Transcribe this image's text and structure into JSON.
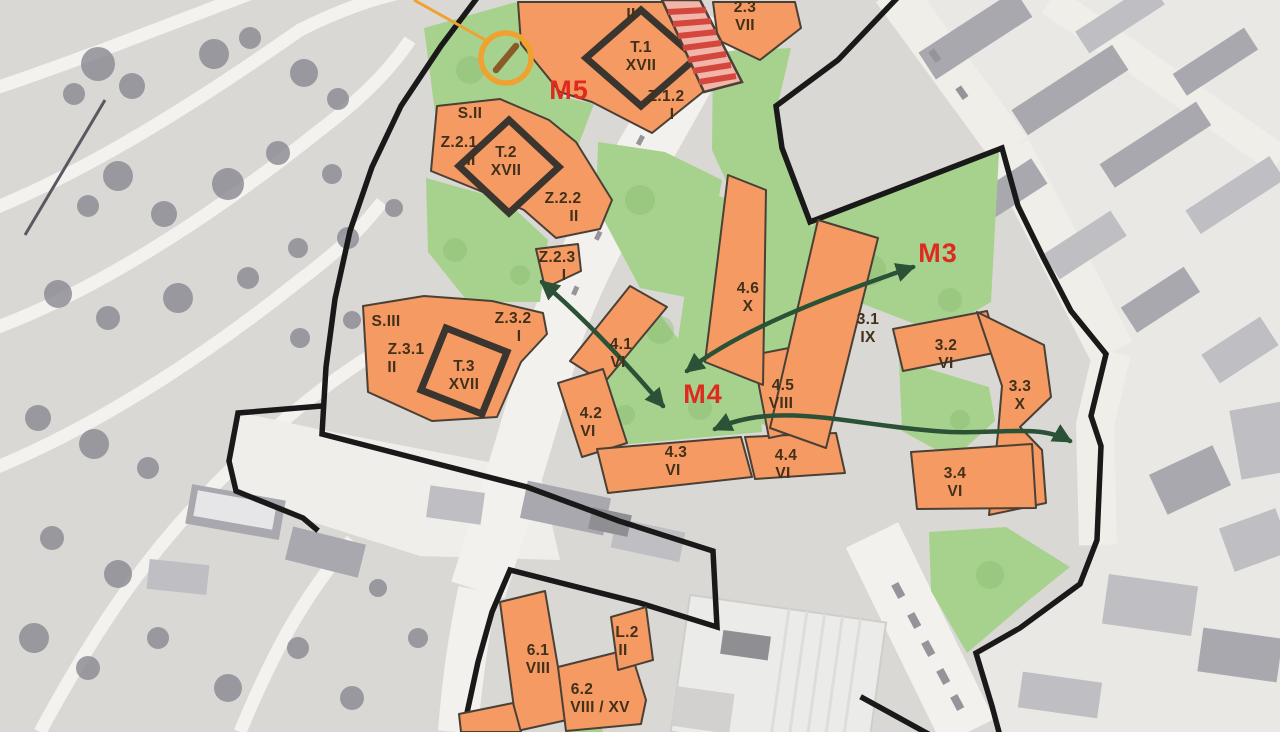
{
  "map": {
    "colors": {
      "building": "#f49a62",
      "green": "#a7d28e",
      "boundary": "#191919",
      "zone_label": "#de2a1f",
      "code_label": "#42301a",
      "arrow": "#2b5136",
      "highlight_circle": "#f0a230",
      "stripe": "#d4473c"
    },
    "zone_labels": [
      {
        "text": "M5",
        "x": 569,
        "y": 99
      },
      {
        "text": "M4",
        "x": 703,
        "y": 403
      },
      {
        "text": "M3",
        "x": 938,
        "y": 262
      }
    ],
    "building_labels": [
      {
        "id": "partial-top",
        "x": 631,
        "y": 19,
        "lines": [
          "II"
        ]
      },
      {
        "id": "t1",
        "x": 641,
        "y": 52,
        "lines": [
          "T.1",
          "XVII"
        ]
      },
      {
        "id": "b23",
        "x": 745,
        "y": 12,
        "lines": [
          "2.3",
          "VII"
        ]
      },
      {
        "id": "z12",
        "x": 666,
        "y": 101,
        "lines": [
          "Z.1.2",
          "I"
        ],
        "dx2": 6
      },
      {
        "id": "s2",
        "x": 470,
        "y": 118,
        "lines": [
          "S.II"
        ]
      },
      {
        "id": "z21",
        "x": 459,
        "y": 147,
        "lines": [
          "Z.2.1",
          "II"
        ],
        "dx2": 12
      },
      {
        "id": "t2",
        "x": 506,
        "y": 157,
        "lines": [
          "T.2",
          "XVII"
        ]
      },
      {
        "id": "z22",
        "x": 563,
        "y": 203,
        "lines": [
          "Z.2.2",
          "II"
        ],
        "dx2": 11
      },
      {
        "id": "z23",
        "x": 557,
        "y": 262,
        "lines": [
          "Z.2.3",
          "I"
        ],
        "dx2": 7
      },
      {
        "id": "s3",
        "x": 386,
        "y": 326,
        "lines": [
          "S.III"
        ]
      },
      {
        "id": "z31",
        "x": 406,
        "y": 354,
        "lines": [
          "Z.3.1",
          "II"
        ],
        "dx2": -14
      },
      {
        "id": "z32",
        "x": 513,
        "y": 323,
        "lines": [
          "Z.3.2",
          "I"
        ],
        "dx2": 6
      },
      {
        "id": "t3",
        "x": 464,
        "y": 371,
        "lines": [
          "T.3",
          "XVII"
        ]
      },
      {
        "id": "b41",
        "x": 621,
        "y": 349,
        "lines": [
          "4.1",
          "VI"
        ],
        "dx2": -3
      },
      {
        "id": "b42",
        "x": 591,
        "y": 418,
        "lines": [
          "4.2",
          "VI"
        ],
        "dx2": -3
      },
      {
        "id": "b43",
        "x": 676,
        "y": 457,
        "lines": [
          "4.3",
          "VI"
        ],
        "dx2": -3
      },
      {
        "id": "b44",
        "x": 786,
        "y": 460,
        "lines": [
          "4.4",
          "VI"
        ],
        "dx2": -3
      },
      {
        "id": "b45",
        "x": 783,
        "y": 390,
        "lines": [
          "4.5",
          "VIII"
        ],
        "dx2": -2
      },
      {
        "id": "b46",
        "x": 748,
        "y": 293,
        "lines": [
          "4.6",
          "X"
        ]
      },
      {
        "id": "b31",
        "x": 868,
        "y": 324,
        "lines": [
          "3.1",
          "IX"
        ]
      },
      {
        "id": "b32",
        "x": 946,
        "y": 350,
        "lines": [
          "3.2",
          "VI"
        ]
      },
      {
        "id": "b33",
        "x": 1020,
        "y": 391,
        "lines": [
          "3.3",
          "X"
        ]
      },
      {
        "id": "b34",
        "x": 955,
        "y": 478,
        "lines": [
          "3.4",
          "VI"
        ]
      },
      {
        "id": "b61",
        "x": 538,
        "y": 655,
        "lines": [
          "6.1",
          "VIII"
        ]
      },
      {
        "id": "b62",
        "x": 582,
        "y": 694,
        "lines": [
          "6.2",
          "VIII / XV"
        ],
        "dx2": 18
      },
      {
        "id": "l2",
        "x": 627,
        "y": 637,
        "lines": [
          "L.2",
          "II"
        ],
        "dx2": -4
      }
    ],
    "icons": [
      {
        "name": "highlight-circle-icon",
        "desc": "orange circled marker with leader line"
      }
    ]
  }
}
